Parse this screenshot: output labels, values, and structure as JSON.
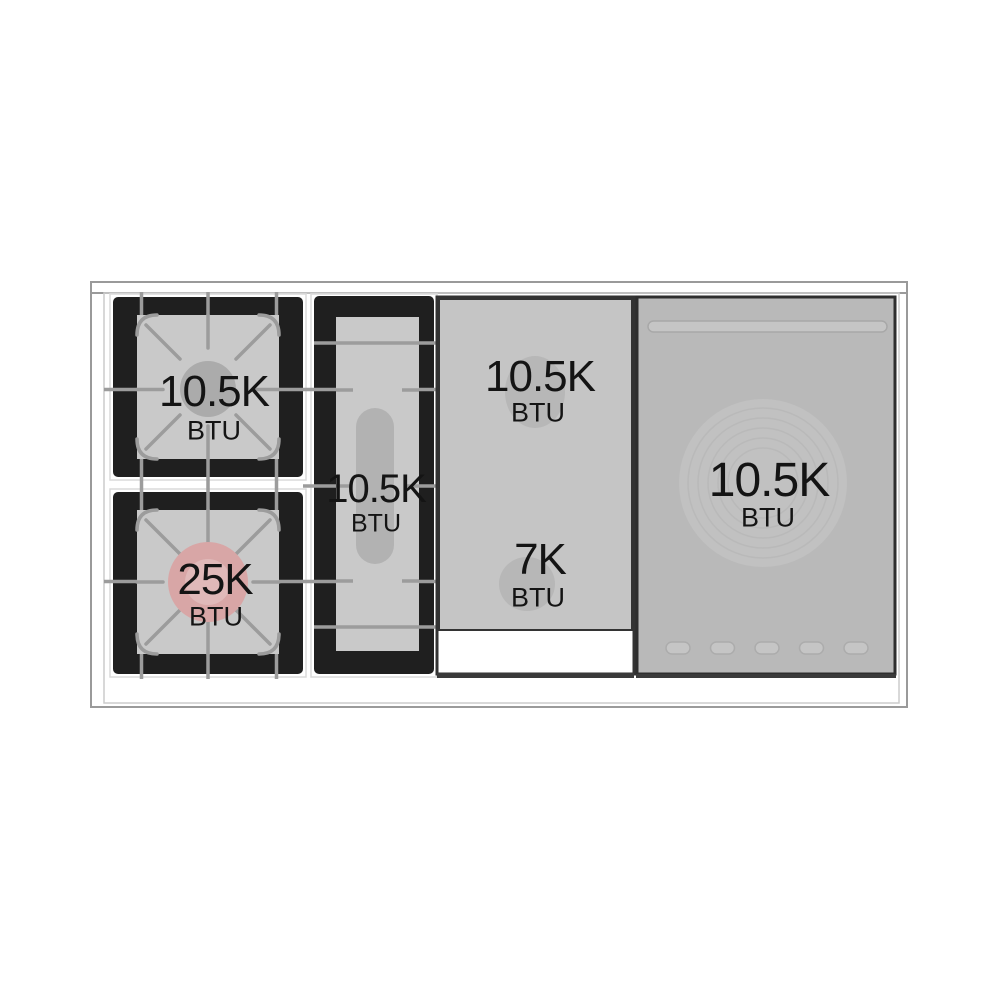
{
  "diagram": {
    "burners": [
      {
        "name": "left-rear-burner",
        "power": "10.5K",
        "unit": "BTU"
      },
      {
        "name": "left-front-burner",
        "power": "25K",
        "unit": "BTU"
      },
      {
        "name": "center-oval-burner",
        "power": "10.5K",
        "unit": "BTU"
      },
      {
        "name": "griddle-rear-burner",
        "power": "10.5K",
        "unit": "BTU"
      },
      {
        "name": "griddle-front-burner",
        "power": "7K",
        "unit": "BTU"
      },
      {
        "name": "right-plate-burner",
        "power": "10.5K",
        "unit": "BTU"
      }
    ],
    "colors": {
      "grate_black": "#1f1f1f",
      "grate_surface": "#c9c9c9",
      "panel_gray": "#b9b9b9",
      "griddle_gray": "#c5c5c5",
      "line_gray": "#9c9c9c",
      "highlight_pink": "#d8a6a6",
      "frame_gray": "#9a9a9a",
      "text": "#141414"
    }
  }
}
